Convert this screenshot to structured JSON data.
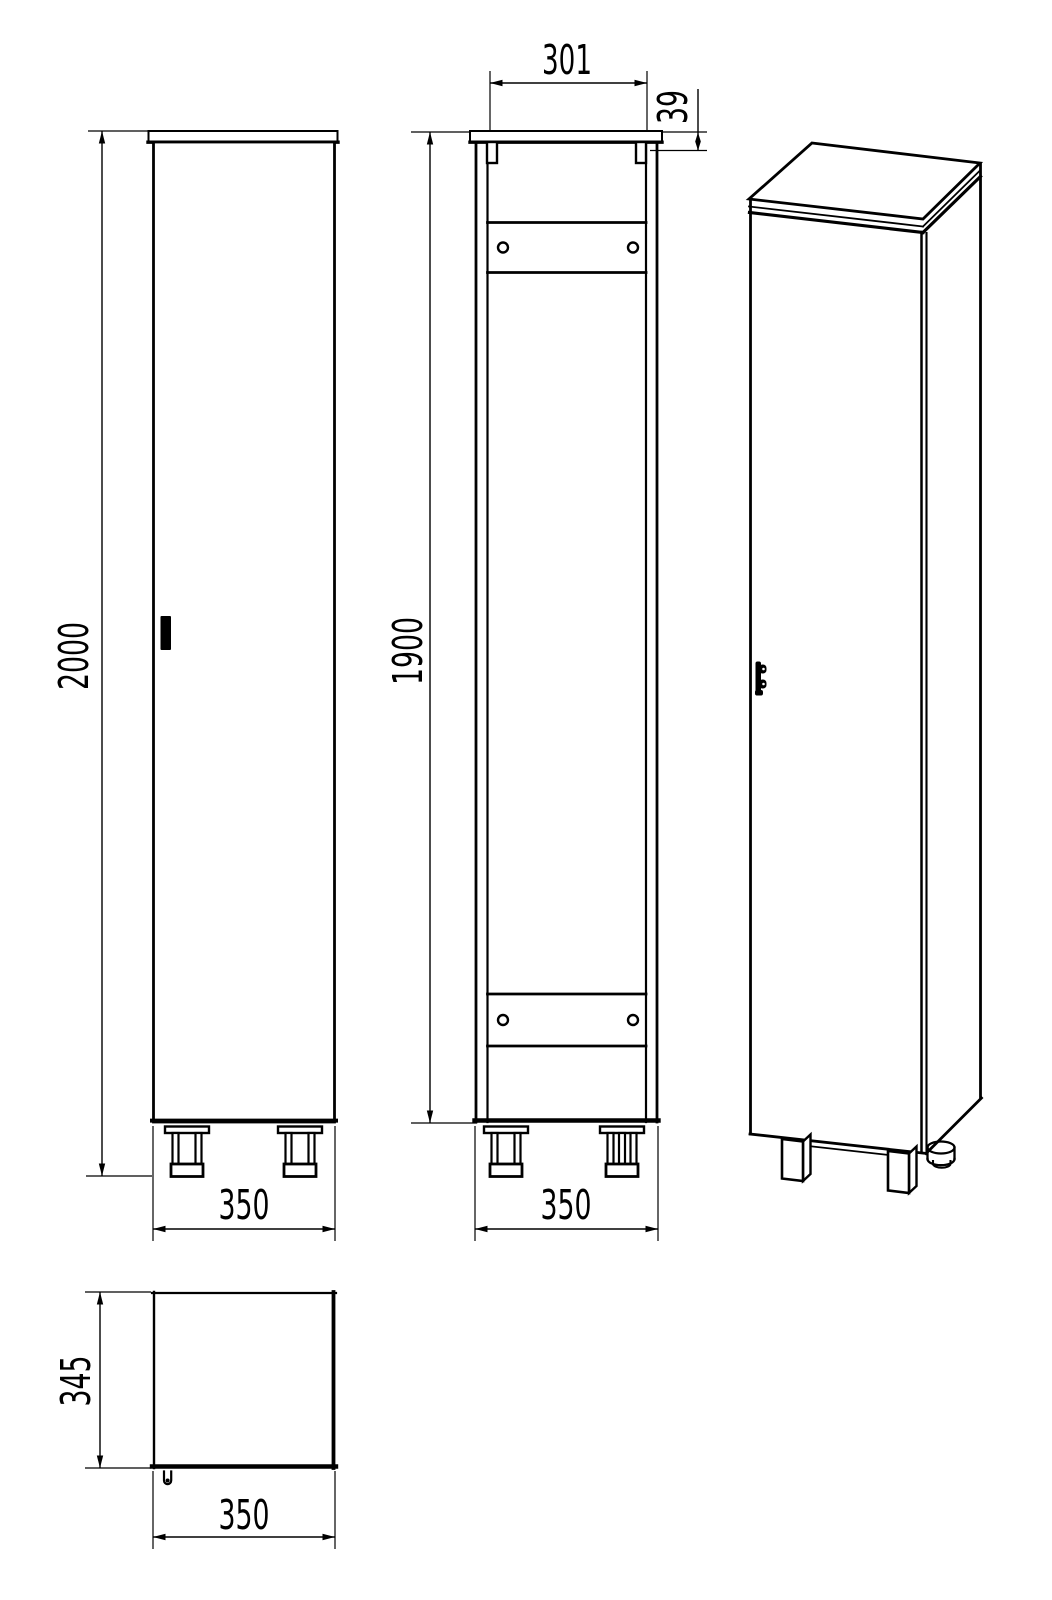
{
  "dimensions": {
    "front_view": {
      "height": "2000",
      "width": "350"
    },
    "back_view": {
      "top_inner_width": "301",
      "hanger_offset": "39",
      "carcass_height": "1900",
      "width": "350"
    },
    "top_view": {
      "depth": "345",
      "width": "350"
    }
  },
  "colors": {
    "line": "#000000",
    "background": "#ffffff"
  }
}
